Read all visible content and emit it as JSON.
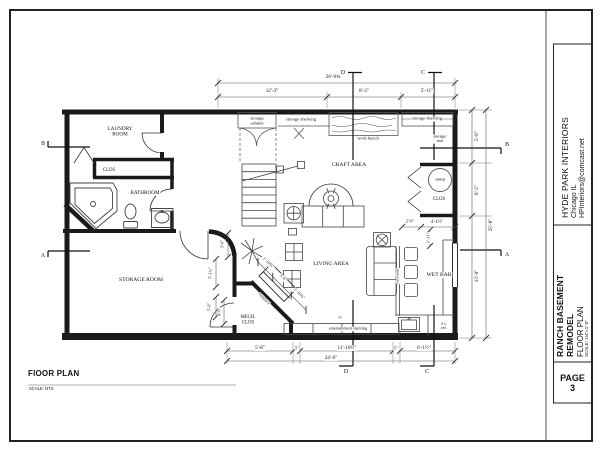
{
  "title_block": {
    "company_name": "HYDE PARK INTERIORS",
    "company_city": "Chicago IL",
    "company_email": "HPInteriors@comcast.net",
    "project_title": "RANCH BASEMENT REMODEL",
    "sheet_title": "FLOOR PLAN",
    "sheet_scale": "SCALE: 1/4\"=1'-0\"",
    "page_label": "PAGE",
    "page_number": "3"
  },
  "footer": {
    "drawing_title": "FlOOR PLAN",
    "drawing_scale": "SCALE: NTS"
  },
  "plan": {
    "labels": {
      "rooms": [
        {
          "name": "laundry-room-label",
          "text": "LAUNDRY\nROOM",
          "x": 120,
          "y": 132,
          "size": 5.2
        },
        {
          "name": "laundry-closet-label",
          "text": "CLOS",
          "x": 109,
          "y": 170,
          "size": 4.8
        },
        {
          "name": "bathroom-label",
          "text": "BATHROOM",
          "x": 145,
          "y": 193,
          "size": 5.2
        },
        {
          "name": "storage-room-label",
          "text": "STORAGE ROOM",
          "x": 141,
          "y": 280,
          "size": 5.6
        },
        {
          "name": "mech-closet-label",
          "text": "MECH.\nCLOS",
          "x": 248,
          "y": 320,
          "size": 4.8
        },
        {
          "name": "craft-area-label",
          "text": "CRAFT AREA",
          "x": 349,
          "y": 165,
          "size": 5.6
        },
        {
          "name": "living-area-label",
          "text": "LIVING AREA",
          "x": 331,
          "y": 264,
          "size": 5.6
        },
        {
          "name": "wet-bar-label",
          "text": "WET BAR",
          "x": 439,
          "y": 275,
          "size": 5.6
        },
        {
          "name": "sump-closet-label",
          "text": "CLOS",
          "x": 439,
          "y": 199,
          "size": 4.8
        }
      ],
      "fixtures": [
        {
          "name": "storage-cabinet-label",
          "text": "storage\ncabinet",
          "x": 257,
          "y": 121,
          "size": 4.6
        },
        {
          "name": "storage-shelving-left-label",
          "text": "storage shelving",
          "x": 301,
          "y": 120,
          "size": 4.6
        },
        {
          "name": "work-bench-label",
          "text": "work bench",
          "x": 368,
          "y": 139,
          "size": 4.6
        },
        {
          "name": "storage-shelving-right-label",
          "text": "storage shelving",
          "x": 427,
          "y": 119,
          "size": 4.6
        },
        {
          "name": "storage-seat-label",
          "text": "storage/\nseat",
          "x": 440,
          "y": 139,
          "size": 4.2
        },
        {
          "name": "sump-label",
          "text": "sump",
          "x": 440,
          "y": 180,
          "size": 4.4
        },
        {
          "name": "half-wall-label",
          "text": "half-wall",
          "x": 398,
          "y": 276,
          "size": 4.2,
          "rot": -90
        },
        {
          "name": "fireplace-label",
          "text": "fireplace",
          "x": 264,
          "y": 299,
          "size": 4.2,
          "rot": 45
        },
        {
          "name": "entertainment-shelving-label",
          "text": "entertainment shelving",
          "x": 348,
          "y": 329,
          "size": 4.2
        },
        {
          "name": "tv-label",
          "text": "tv",
          "x": 340,
          "y": 318,
          "size": 3.8
        },
        {
          "name": "uc-ref-label",
          "text": "u.c.\nref.",
          "x": 444,
          "y": 326,
          "size": 4.2
        }
      ],
      "dimensions": [
        {
          "name": "dim-top-overall",
          "text": "26'-6¾\"",
          "x": 334,
          "y": 77,
          "size": 5.2
        },
        {
          "name": "dim-top-left",
          "text": "12'-3\"",
          "x": 272,
          "y": 91,
          "size": 5.2
        },
        {
          "name": "dim-top-mid",
          "text": "8'-3\"",
          "x": 364,
          "y": 91,
          "size": 5.2
        },
        {
          "name": "dim-top-right",
          "text": "5'-11\"",
          "x": 427,
          "y": 91,
          "size": 5.2
        },
        {
          "name": "dim-right-top",
          "text": "5'-8\"",
          "x": 477,
          "y": 136,
          "size": 5.2,
          "rot": -90
        },
        {
          "name": "dim-right-mid",
          "text": "8'-2\"",
          "x": 477,
          "y": 190,
          "size": 5.2,
          "rot": -90
        },
        {
          "name": "dim-right-overall",
          "text": "25'-8\"",
          "x": 491,
          "y": 225,
          "size": 5.2,
          "rot": -90
        },
        {
          "name": "dim-right-bottom",
          "text": "13'-0\"",
          "x": 477,
          "y": 276,
          "size": 5.2,
          "rot": -90
        },
        {
          "name": "dim-sump-width",
          "text": "4'-1½\"",
          "x": 437,
          "y": 222,
          "size": 4.8
        },
        {
          "name": "dim-sump-door",
          "text": "2'-0\"",
          "x": 410,
          "y": 222,
          "size": 4.4
        },
        {
          "name": "dim-sump-depth",
          "text": "1'-11\"",
          "x": 429,
          "y": 238,
          "size": 4.4,
          "rot": -90
        },
        {
          "name": "dim-hall-width",
          "text": "3'-0\"",
          "x": 223,
          "y": 244,
          "size": 4.4,
          "rot": -90
        },
        {
          "name": "dim-storage-door-a",
          "text": "5'-1¾\"",
          "x": 211,
          "y": 273,
          "size": 4.4,
          "rot": -90
        },
        {
          "name": "dim-storage-door-b",
          "text": "5'-0\"",
          "x": 210,
          "y": 307,
          "size": 4.4,
          "rot": -90
        },
        {
          "name": "dim-mech-door",
          "text": "4'-0\"",
          "x": 220,
          "y": 312,
          "size": 4.4,
          "rot": -90
        },
        {
          "name": "dim-fireplace-a",
          "text": "1'-10¾\"",
          "x": 268,
          "y": 263,
          "size": 4.4,
          "rot": 45
        },
        {
          "name": "dim-fireplace-b",
          "text": "5'-0\"",
          "x": 283,
          "y": 278,
          "size": 4.4,
          "rot": 45
        },
        {
          "name": "dim-fireplace-c",
          "text": "1'-10¾\"",
          "x": 299,
          "y": 294,
          "size": 4.4,
          "rot": 45
        },
        {
          "name": "dim-bottom-1",
          "text": "5'-8\"",
          "x": 260,
          "y": 348,
          "size": 5.2
        },
        {
          "name": "dim-bottom-gap1",
          "text": "5\"",
          "x": 297,
          "y": 349,
          "size": 4.4
        },
        {
          "name": "dim-bottom-2",
          "text": "11'-10½\"",
          "x": 347,
          "y": 348,
          "size": 5.2
        },
        {
          "name": "dim-bottom-gap2",
          "text": "5\"",
          "x": 396,
          "y": 349,
          "size": 4.4
        },
        {
          "name": "dim-bottom-3",
          "text": "6'-1½\"",
          "x": 424,
          "y": 348,
          "size": 5.2
        },
        {
          "name": "dim-bottom-overall",
          "text": "24'-6\"",
          "x": 331,
          "y": 358,
          "size": 5.2
        }
      ],
      "section_markers": [
        {
          "name": "section-d-top",
          "text": "D",
          "x": 343,
          "y": 73,
          "size": 5.8
        },
        {
          "name": "section-c-top",
          "text": "C",
          "x": 423,
          "y": 73,
          "size": 5.8
        },
        {
          "name": "section-b-left",
          "text": "B",
          "x": 43,
          "y": 144,
          "size": 5.8
        },
        {
          "name": "section-a-left",
          "text": "A",
          "x": 43,
          "y": 256,
          "size": 5.8
        },
        {
          "name": "section-b-right",
          "text": "B",
          "x": 507,
          "y": 145,
          "size": 5.8
        },
        {
          "name": "section-a-right",
          "text": "A",
          "x": 507,
          "y": 255,
          "size": 5.8
        },
        {
          "name": "section-d-bottom",
          "text": "D",
          "x": 346,
          "y": 372,
          "size": 5.8
        },
        {
          "name": "section-c-bottom",
          "text": "C",
          "x": 427,
          "y": 372,
          "size": 5.8
        }
      ]
    }
  }
}
